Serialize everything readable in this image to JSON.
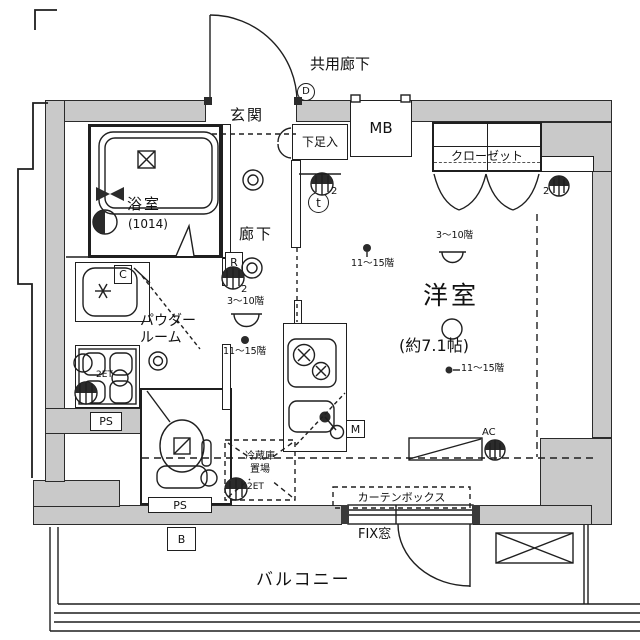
{
  "colors": {
    "wall_fill": "#c9c9c9",
    "line_color": "#1f1f1f"
  },
  "labels": {
    "common_corridor": "共用廊下",
    "entrance": "玄関",
    "shoe_cabinet": "下足入",
    "meter_box": "MB",
    "closet": "クローゼット",
    "bathroom": "浴室",
    "bathroom_size": "(1014)",
    "hallway": "廊下",
    "powder_room_line1": "パウダー",
    "powder_room_line2": "ルーム",
    "main_room": "洋室",
    "main_room_size": "(約7.1帖)",
    "fridge_line1": "冷蔵庫",
    "fridge_line2": "置場",
    "curtain_box": "カーテンボックス",
    "fix_window": "FIX窓",
    "balcony": "バルコニー",
    "pipe_space_left": "PS",
    "pipe_space_bottom": "PS",
    "balcony_b": "B",
    "kitchen_m": "M",
    "hall_r": "R",
    "powder_c": "C",
    "entrance_d": "D",
    "tv_t": "t",
    "ac": "AC"
  },
  "annotations": {
    "outlet2_entrance": "2",
    "outlet2_hall": "2",
    "outlet2_closet": "2",
    "outlet_2et_washer": "2ET",
    "outlet_2et_fridge": "2ET",
    "hall_floors_upper": "3〜10階",
    "hall_floors_lower": "11〜15階",
    "room_floors_left": "11〜15階",
    "room_floors_upper": "3〜10階",
    "room_floors_lower": "11〜15階"
  }
}
